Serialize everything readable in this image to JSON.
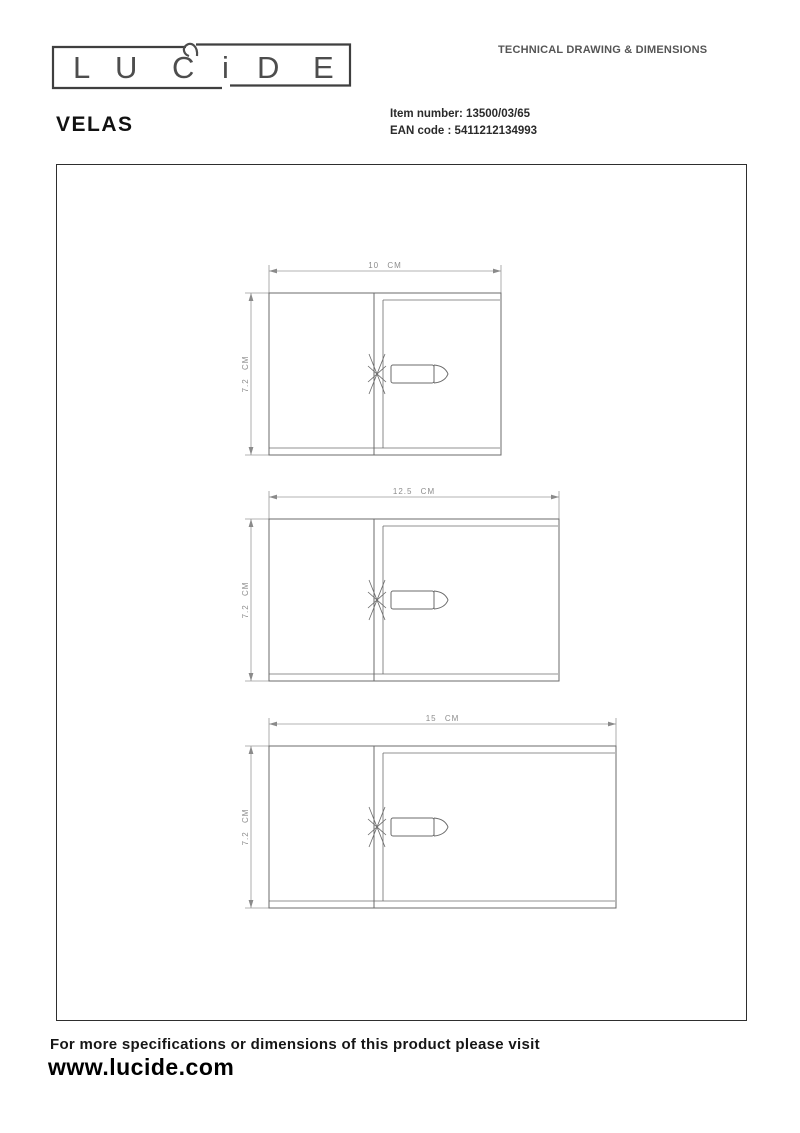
{
  "header": {
    "brand_letters": [
      "L",
      "U",
      "C",
      "i",
      "D",
      "E"
    ],
    "tagline": "TECHNICAL DRAWING & DIMENSIONS"
  },
  "product": {
    "name": "VELAS",
    "item_number_label": "Item number:",
    "item_number": "13500/03/65",
    "ean_label": "EAN code :",
    "ean": "5411212134993"
  },
  "drawings": [
    {
      "width_label": "10 CM",
      "height_label": "7.2 CM"
    },
    {
      "width_label": "12.5 CM",
      "height_label": "7.2 CM"
    },
    {
      "width_label": "15 CM",
      "height_label": "7.2 CM"
    }
  ],
  "footer": {
    "note": "For more specifications or dimensions of this product please visit",
    "url": "www.lucide.com"
  },
  "colors": {
    "line": "#6b6b6b",
    "dim_text": "#8c8c8c",
    "text": "#1a1a1a"
  }
}
